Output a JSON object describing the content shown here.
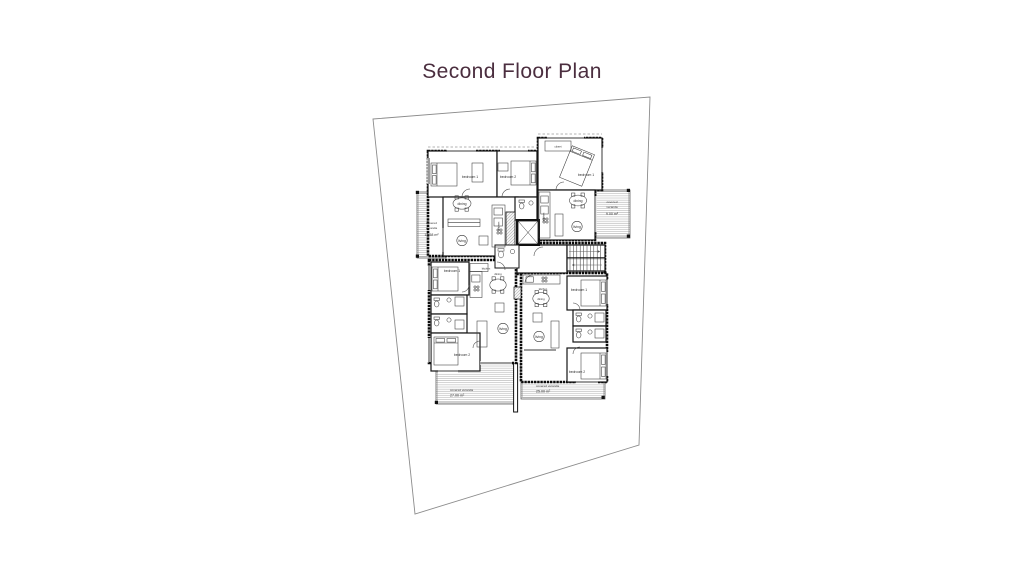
{
  "title": {
    "text": "Second Floor Plan"
  },
  "colors": {
    "title": "#4b2e3f",
    "wall": "#141414",
    "boundary": "#8c8c8c",
    "deck_hatch": "#9f9f9f"
  },
  "plan": {
    "verandas": {
      "upper_left": {
        "l1": "covered",
        "l2": "veranda",
        "area": "13.58 m²"
      },
      "upper_right": {
        "l1": "covered",
        "l2": "veranda",
        "area": "9.00 m²"
      },
      "lower_left": {
        "l1": "covered veranda",
        "area": "27.00 m²"
      },
      "lower_right": {
        "l1": "covered veranda",
        "area": "25.00 m²"
      }
    },
    "rooms": {
      "ul_bedroom1": "bedroom 1",
      "ul_bedroom2": "bedroom 2",
      "ul_dining": "dining",
      "ul_living": "living",
      "ul_kitchen": "kitchen",
      "ur_closet": "closet",
      "ur_bedroom1": "bedroom 1",
      "ur_dining": "dining",
      "ur_living": "living",
      "ur_kitchen": "kitchen",
      "ll_bedroom1": "bedroom 1",
      "ll_bedroom2": "bedroom 2",
      "ll_kitchen": "kitchen",
      "ll_dining": "dining",
      "ll_living": "living",
      "lr_bedroom1": "bedroom 1",
      "lr_bedroom2": "bedroom 2",
      "lr_kitchen": "kitchen",
      "lr_dining": "dining",
      "lr_living": "living"
    }
  }
}
